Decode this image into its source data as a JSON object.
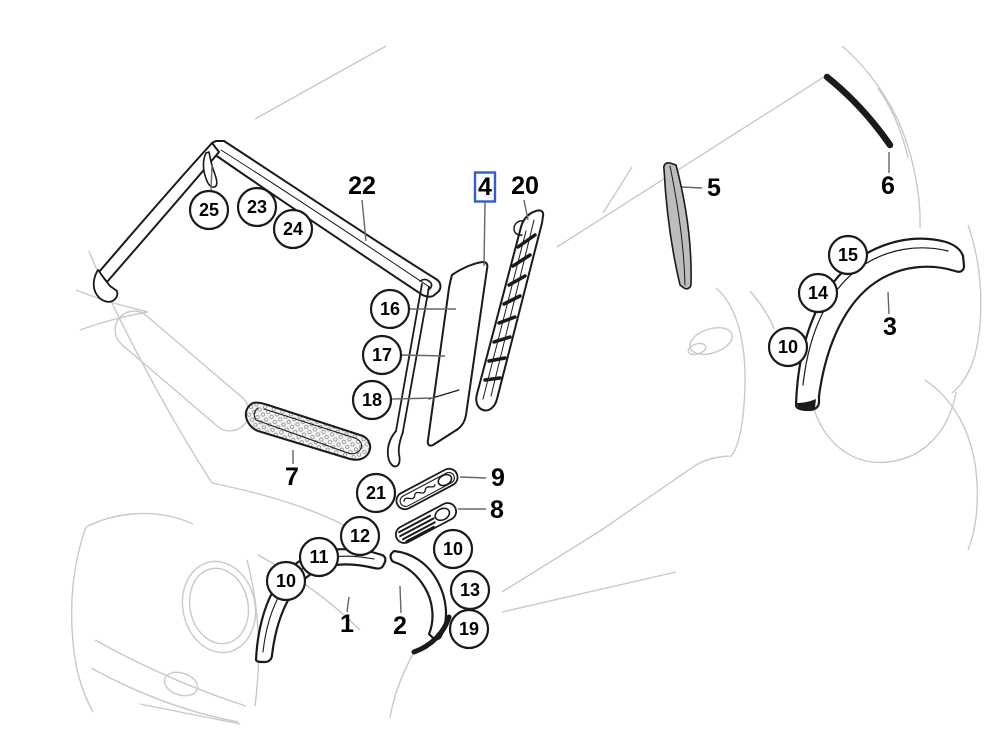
{
  "diagram": {
    "kind": "vehicle exterior trim parts diagram",
    "selected_part": "4"
  },
  "callouts": [
    {
      "label": "25",
      "x": 209,
      "y": 210
    },
    {
      "label": "23",
      "x": 257,
      "y": 207
    },
    {
      "label": "24",
      "x": 293,
      "y": 229
    },
    {
      "label": "16",
      "x": 390,
      "y": 309
    },
    {
      "label": "17",
      "x": 382,
      "y": 355
    },
    {
      "label": "18",
      "x": 372,
      "y": 400
    },
    {
      "label": "21",
      "x": 376,
      "y": 493
    },
    {
      "label": "12",
      "x": 360,
      "y": 536
    },
    {
      "label": "11",
      "x": 319,
      "y": 557
    },
    {
      "label": "10",
      "x": 286,
      "y": 581
    },
    {
      "label": "10",
      "x": 453,
      "y": 549
    },
    {
      "label": "13",
      "x": 470,
      "y": 590
    },
    {
      "label": "19",
      "x": 469,
      "y": 629
    },
    {
      "label": "15",
      "x": 848,
      "y": 255
    },
    {
      "label": "14",
      "x": 818,
      "y": 293
    },
    {
      "label": "10",
      "x": 788,
      "y": 347
    }
  ],
  "labels": [
    {
      "label": "22",
      "x": 362,
      "y": 186,
      "highlighted": false
    },
    {
      "label": "4",
      "x": 485,
      "y": 187,
      "highlighted": true
    },
    {
      "label": "20",
      "x": 525,
      "y": 186,
      "highlighted": false
    },
    {
      "label": "5",
      "x": 714,
      "y": 188,
      "highlighted": false
    },
    {
      "label": "6",
      "x": 888,
      "y": 186,
      "highlighted": false
    },
    {
      "label": "3",
      "x": 890,
      "y": 327,
      "highlighted": false
    },
    {
      "label": "7",
      "x": 292,
      "y": 477,
      "highlighted": false
    },
    {
      "label": "9",
      "x": 498,
      "y": 478,
      "highlighted": false
    },
    {
      "label": "8",
      "x": 497,
      "y": 510,
      "highlighted": false
    },
    {
      "label": "1",
      "x": 347,
      "y": 624,
      "highlighted": false
    },
    {
      "label": "2",
      "x": 400,
      "y": 626,
      "highlighted": false
    }
  ],
  "colors": {
    "part_outline": "#1a1a1a",
    "body_outline": "#c9c9c9",
    "leader_line": "#666666",
    "highlight_box": "#2f5fcf",
    "balloon_stroke": "#1a1a1a",
    "background": "#ffffff"
  }
}
